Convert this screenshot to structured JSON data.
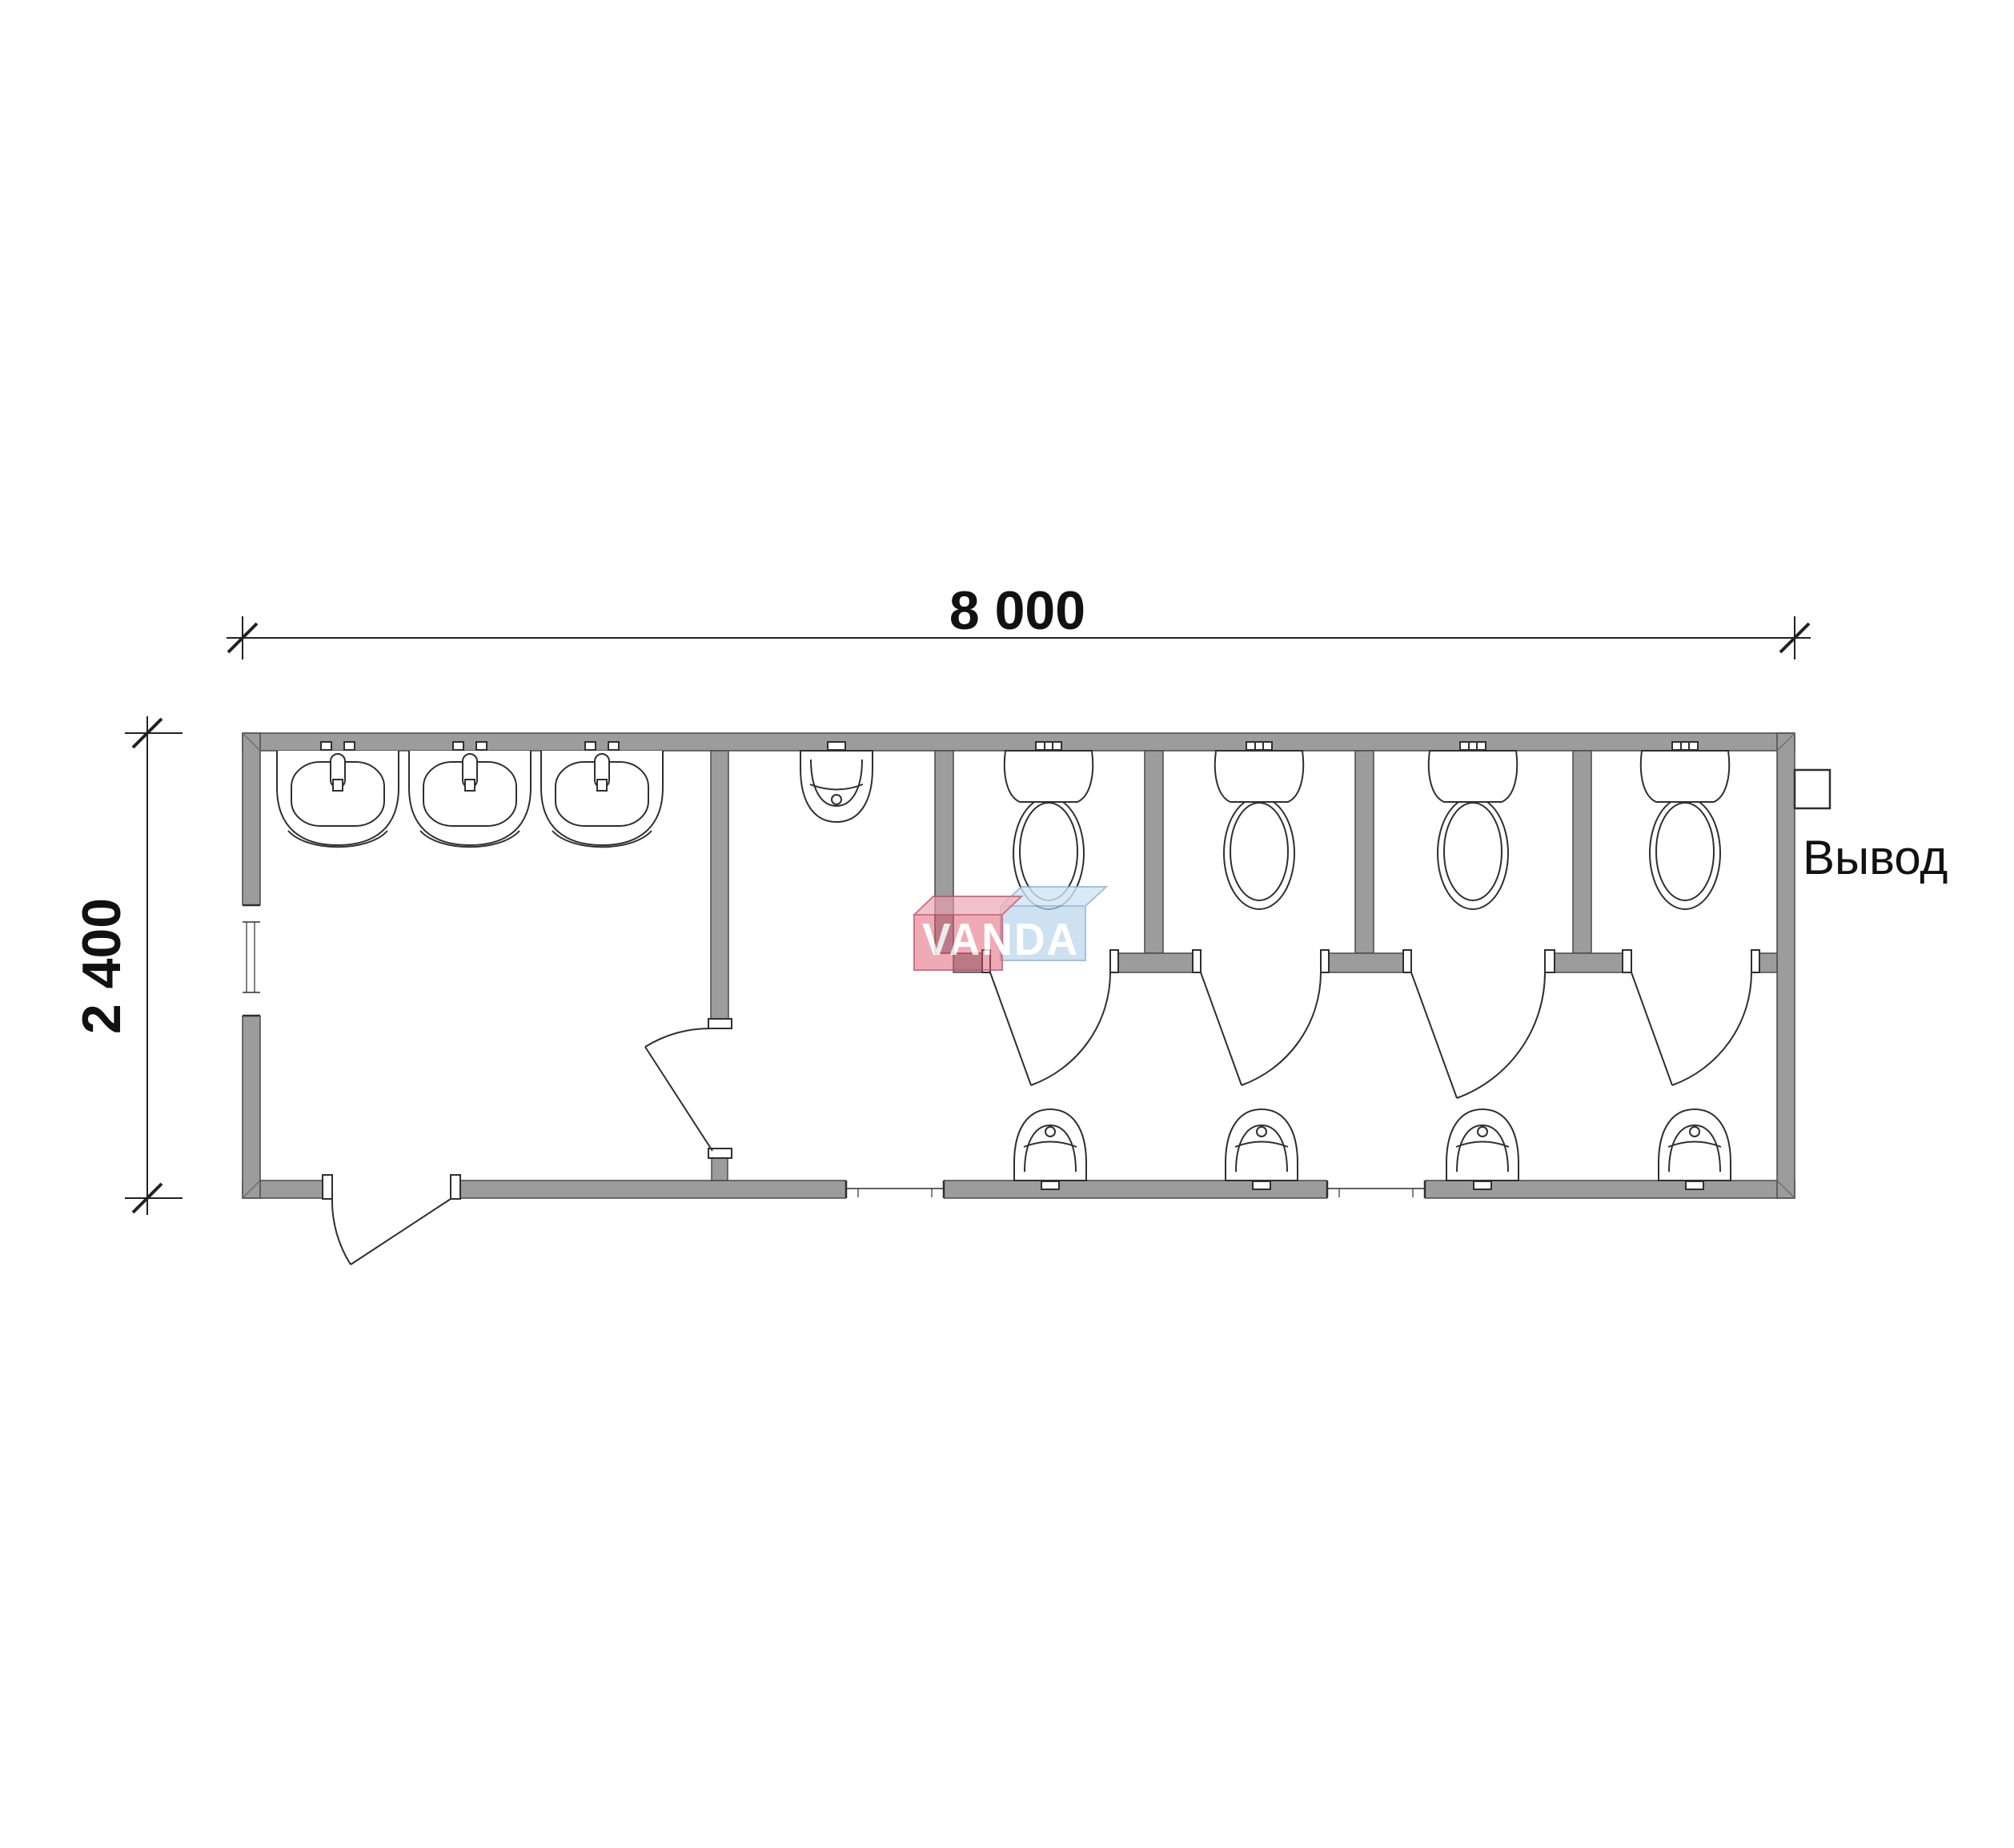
{
  "plan": {
    "width_label": "8 000",
    "height_label": "2 400",
    "outlet_label": "Вывод",
    "watermark_text": "VANDA"
  },
  "colors": {
    "background": "#ffffff",
    "wall_fill": "#9c9c9c",
    "wall_stroke": "#4a4a4a",
    "fixture_stroke": "#2f2f2f",
    "dim_line": "#222222",
    "watermark_red_front": "#e0556e",
    "watermark_red_top": "#eba0ae",
    "watermark_blue_front": "#b5d3ea",
    "watermark_blue_top": "#d0e4f4"
  },
  "fixtures_summary": {
    "washbasins": 3,
    "wall_urinal": 1,
    "toilets": 4,
    "toilet_stalls": 4,
    "corridor_urinals": 4,
    "windows": 3,
    "doors": 6
  }
}
